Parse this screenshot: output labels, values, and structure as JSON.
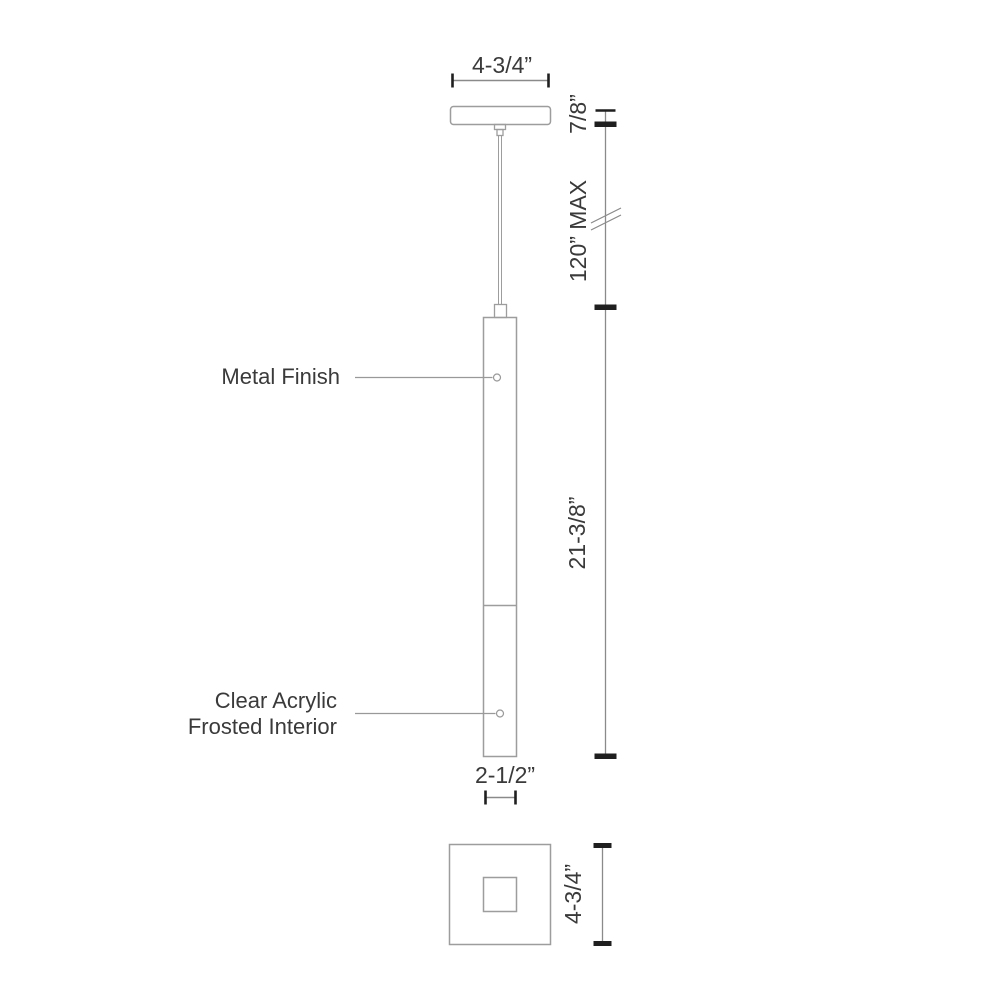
{
  "drawing": {
    "subject": "pendant-light-dimension-drawing",
    "front_view": {
      "callouts": {
        "metal_finish": "Metal Finish",
        "diffuser_line1": "Clear Acrylic",
        "diffuser_line2": "Frosted Interior"
      },
      "dimensions": {
        "canopy_width": "4-3/4”",
        "canopy_height": "7/8”",
        "cord_length_max": "120” MAX",
        "fixture_height": "21-3/8”",
        "fixture_width": "2-1/2”"
      }
    },
    "plan_view": {
      "dimensions": {
        "canopy_side": "4-3/4”"
      }
    }
  },
  "colors": {
    "background": "#ffffff",
    "outline": "#9d9d9d",
    "dimension_line": "#8a8a8a",
    "tick": "#1f1f1f",
    "text": "#3a3a3a"
  }
}
